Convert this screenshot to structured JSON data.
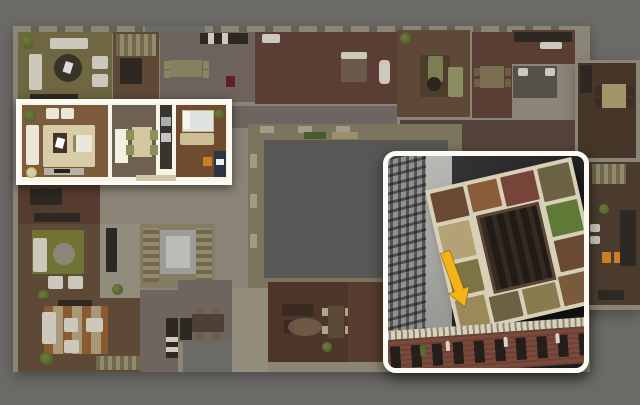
{
  "scene": {
    "kind": "apartment-floorplan-render",
    "highlight_label": "selected-apartment",
    "inset_label": "building-3d-overview",
    "arrow_label": "apartment-location-pointer"
  },
  "palette": {
    "bg": "#6b6a67",
    "bg-dark": "#585755",
    "wall": "#8b8577",
    "walkway": "#7b755f",
    "wood": "#5e4936",
    "wood-dark": "#46362a",
    "wood-red": "#573d2f",
    "brick-floor": "#5a3e35",
    "tile": "#6d635c",
    "tile-mauve": "#6f6560",
    "olive-floor": "#6e6741",
    "cream-floor": "#928c7c",
    "white-furn": "#ccc8bb",
    "dark-furn": "#2e2822",
    "green-plant": "#55622e",
    "sage": "#7b7d54",
    "sage-light": "#8c8d62",
    "rug-olive": "#6f7434",
    "rug-stripe-a": "#8a5a30",
    "rug-stripe-b": "#a89878",
    "elevator-outer": "#9c9c98",
    "elevator-inner": "#bbbbb7",
    "stairs-floor": "#857c63",
    "highlight-border": "#fdfcf4",
    "hl-wall": "#f7f4e8",
    "hl-wood": "#7d5c3d",
    "hl-wood-dark": "#6f4c2f",
    "hl-taupe": "#6f6152",
    "hl-carpet": "#d9cda8",
    "hl-white": "#ebe8da",
    "hl-kitchen": "#3a342c",
    "bed-duvet": "#dfe3e1",
    "inset-border": "#fcfbf3",
    "inset-bg-1": "#3d3d3f",
    "inset-bg-2": "#1b1b1d",
    "inset-bldg-gray": "#909090",
    "inset-wedge": "#b9b9b5",
    "plan-cream": "#d8d0b6",
    "courtyard-inset": "#211c17",
    "facade-brick": "#7b4a3c",
    "facade-cornice": "#d8d2bd",
    "facade-window": "#241f1b",
    "statue": "#d9d4c6",
    "arrow": "#f2b414",
    "orange-accent": "#cc7f22"
  }
}
